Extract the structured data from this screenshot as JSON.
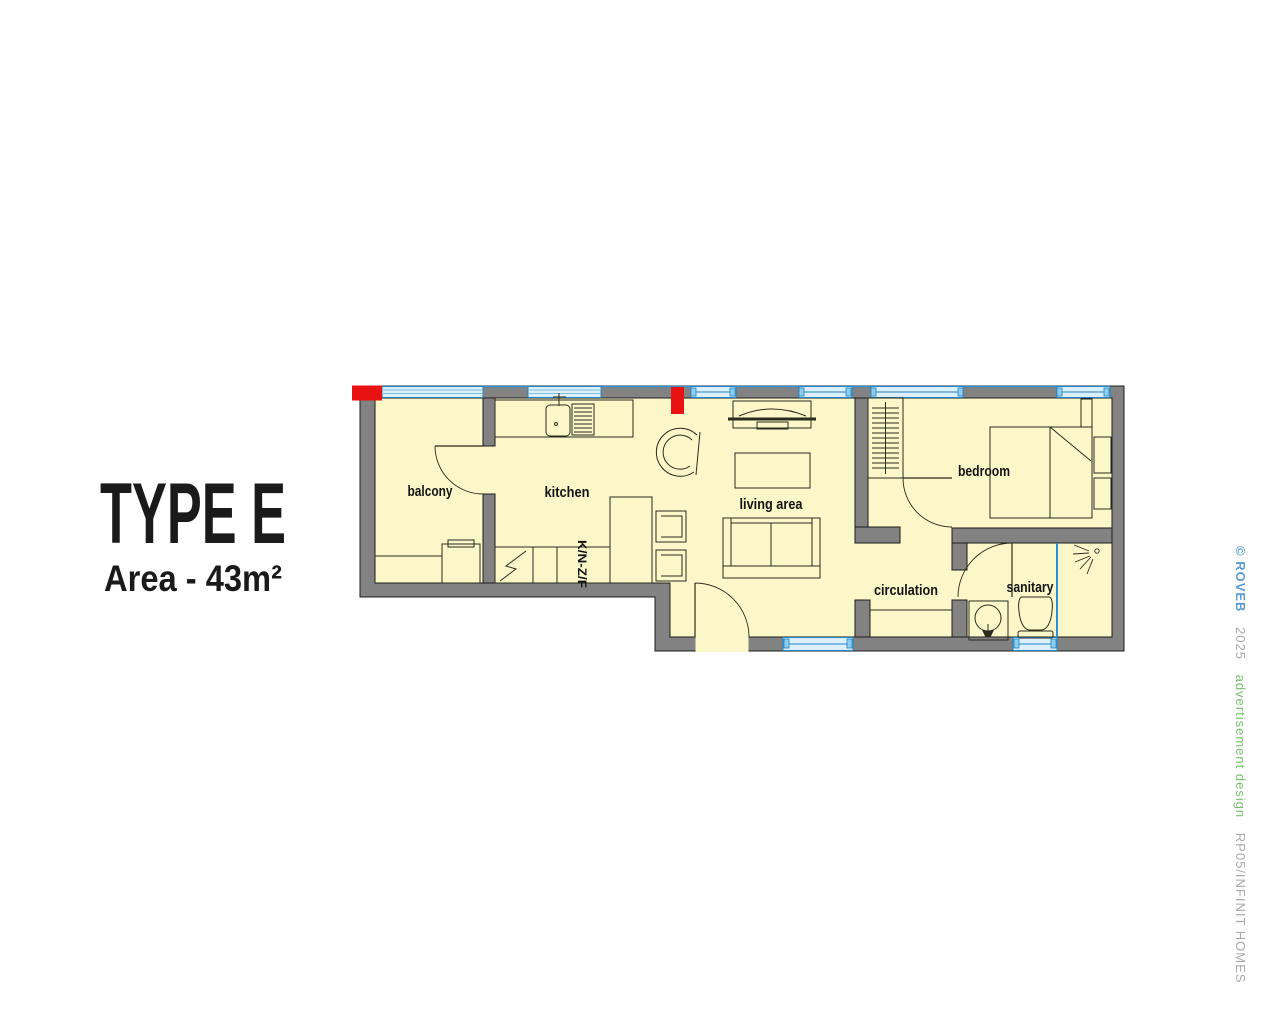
{
  "title": {
    "type": "TYPE E",
    "area": "Area - 43m²"
  },
  "floorplan": {
    "labels": {
      "balcony": "balcony",
      "kitchen": "kitchen",
      "kitchen_units_code": "K/N-Z/F",
      "living": "living area",
      "bedroom": "bedroom",
      "circulation": "circulation",
      "sanitary": "sanitary"
    },
    "colors": {
      "wall_gray": "#828282",
      "floor_yellow": "#FBF7C9",
      "window_frame_blue": "#1E86C8",
      "window_fill_blue": "#DCEFFA",
      "marker_red": "#E81212",
      "drawing_line": "#2B2B1E"
    }
  },
  "watermark": {
    "copyright": "© ROVEB",
    "year": "2025",
    "design_credit": "advertisement design",
    "project_code": "RP05/INFINIT HOMES",
    "colors": {
      "copyright_blue": "#5B9BD5",
      "muted_gray": "#A9A9A9",
      "design_green": "#79C06E"
    }
  }
}
